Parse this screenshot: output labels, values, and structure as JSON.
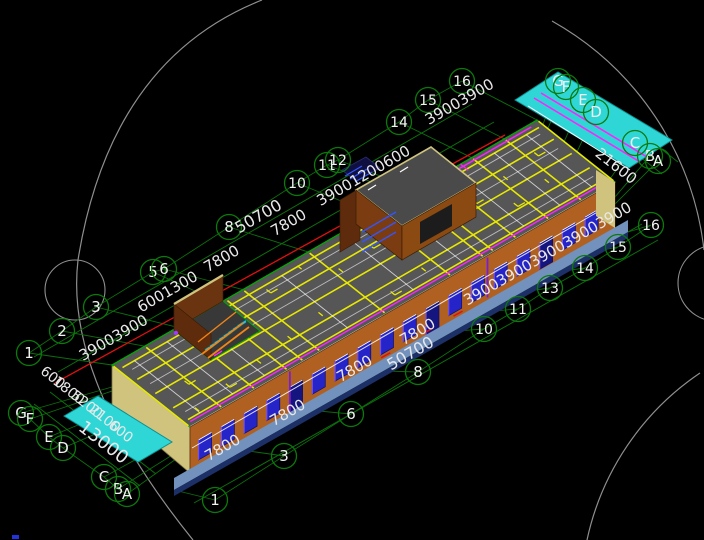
{
  "viewport": {
    "width": 704,
    "height": 540,
    "background": "#000000"
  },
  "palette": {
    "grid_bubble": "#0b7a0b",
    "dim_line": "#0c6e0c",
    "dim_text": "#e8e8e8",
    "reference_circle": "#8f8f8f",
    "roof": "#565656",
    "roof_grid_yellow": "#e8e800",
    "roof_outline_green": "#00a800",
    "wall_orange": "#b06020",
    "wall_brown": "#7a3c10",
    "wall_brown_dark": "#5e2c0c",
    "end_wall_khaki": "#cfc37e",
    "window_blue": "#2424c8",
    "window_frame_purple": "#7a50e8",
    "plinth_blue": "#7291bd",
    "plinth_navy": "#1c2f66",
    "canopy_cyan": "#2fd6d6",
    "stair_cyan": "#38bcd8",
    "stair_rail_orange": "#f08515",
    "accent_magenta": "#ff22ff",
    "accent_red": "#e01010",
    "corner_mark_blue": "#2233dd"
  },
  "grid_bubbles": {
    "top_edge": [
      {
        "label": "1",
        "x": 29,
        "y": 353
      },
      {
        "label": "2",
        "x": 62,
        "y": 331
      },
      {
        "label": "3",
        "x": 96,
        "y": 307
      },
      {
        "label": "5",
        "x": 153,
        "y": 272
      },
      {
        "label": "6",
        "x": 164,
        "y": 269
      },
      {
        "label": "8",
        "x": 229,
        "y": 227
      },
      {
        "label": "10",
        "x": 297,
        "y": 183
      },
      {
        "label": "11",
        "x": 327,
        "y": 165
      },
      {
        "label": "12",
        "x": 338,
        "y": 160
      },
      {
        "label": "14",
        "x": 399,
        "y": 122
      },
      {
        "label": "15",
        "x": 428,
        "y": 100
      },
      {
        "label": "16",
        "x": 462,
        "y": 81
      }
    ],
    "bottom_edge": [
      {
        "label": "1",
        "x": 215,
        "y": 500
      },
      {
        "label": "3",
        "x": 284,
        "y": 456
      },
      {
        "label": "6",
        "x": 351,
        "y": 414
      },
      {
        "label": "8",
        "x": 418,
        "y": 372
      },
      {
        "label": "10",
        "x": 484,
        "y": 329
      },
      {
        "label": "11",
        "x": 518,
        "y": 309
      },
      {
        "label": "13",
        "x": 550,
        "y": 288
      },
      {
        "label": "14",
        "x": 585,
        "y": 268
      },
      {
        "label": "15",
        "x": 618,
        "y": 247
      },
      {
        "label": "16",
        "x": 651,
        "y": 225
      }
    ],
    "left_end": [
      {
        "label": "G",
        "x": 21,
        "y": 413
      },
      {
        "label": "F",
        "x": 30,
        "y": 419
      },
      {
        "label": "E",
        "x": 49,
        "y": 437
      },
      {
        "label": "D",
        "x": 63,
        "y": 448
      },
      {
        "label": "C",
        "x": 104,
        "y": 477
      },
      {
        "label": "B",
        "x": 118,
        "y": 489
      },
      {
        "label": "A",
        "x": 127,
        "y": 494
      }
    ],
    "right_end": [
      {
        "label": "G",
        "x": 558,
        "y": 81
      },
      {
        "label": "F",
        "x": 566,
        "y": 87
      },
      {
        "label": "E",
        "x": 583,
        "y": 100
      },
      {
        "label": "D",
        "x": 596,
        "y": 112
      },
      {
        "label": "C",
        "x": 635,
        "y": 143
      },
      {
        "label": "B",
        "x": 650,
        "y": 156
      },
      {
        "label": "A",
        "x": 658,
        "y": 161
      }
    ]
  },
  "dimension_texts": {
    "top_edge": [
      {
        "text": "39003900",
        "x": 116,
        "y": 342,
        "rot": -30,
        "size": 15
      },
      {
        "text": "6001300",
        "x": 170,
        "y": 296,
        "rot": -30,
        "size": 15
      },
      {
        "text": "7800",
        "x": 224,
        "y": 263,
        "rot": -30,
        "size": 15
      },
      {
        "text": "50700",
        "x": 261,
        "y": 221,
        "rot": -30,
        "size": 16
      },
      {
        "text": "7800",
        "x": 291,
        "y": 227,
        "rot": -30,
        "size": 15
      },
      {
        "text": "39001200600",
        "x": 366,
        "y": 180,
        "rot": -30,
        "size": 15
      },
      {
        "text": "39003900",
        "x": 462,
        "y": 106,
        "rot": -30,
        "size": 15
      }
    ],
    "bottom_edge": [
      {
        "text": "7800",
        "x": 225,
        "y": 452,
        "rot": -30,
        "size": 15
      },
      {
        "text": "7800",
        "x": 290,
        "y": 417,
        "rot": -30,
        "size": 15
      },
      {
        "text": "7800",
        "x": 357,
        "y": 373,
        "rot": -30,
        "size": 15
      },
      {
        "text": "50700",
        "x": 413,
        "y": 358,
        "rot": -30,
        "size": 16
      },
      {
        "text": "7800",
        "x": 420,
        "y": 336,
        "rot": -30,
        "size": 15
      },
      {
        "text": "39003900390039003900",
        "x": 550,
        "y": 258,
        "rot": -30,
        "size": 15
      }
    ],
    "left_end": [
      {
        "text": "600",
        "x": 50,
        "y": 381,
        "rot": 38,
        "size": 14
      },
      {
        "text": "1800",
        "x": 66,
        "y": 394,
        "rot": 38,
        "size": 14
      },
      {
        "text": "5200",
        "x": 84,
        "y": 408,
        "rot": 38,
        "size": 14
      },
      {
        "text": "2100",
        "x": 102,
        "y": 422,
        "rot": 38,
        "size": 14
      },
      {
        "text": "600",
        "x": 118,
        "y": 435,
        "rot": 38,
        "size": 14
      },
      {
        "text": "13000",
        "x": 100,
        "y": 447,
        "rot": 38,
        "size": 18
      }
    ],
    "right_end": [
      {
        "text": "21600",
        "x": 613,
        "y": 170,
        "rot": 38,
        "size": 15
      }
    ]
  },
  "facade": {
    "window_count": 18
  }
}
